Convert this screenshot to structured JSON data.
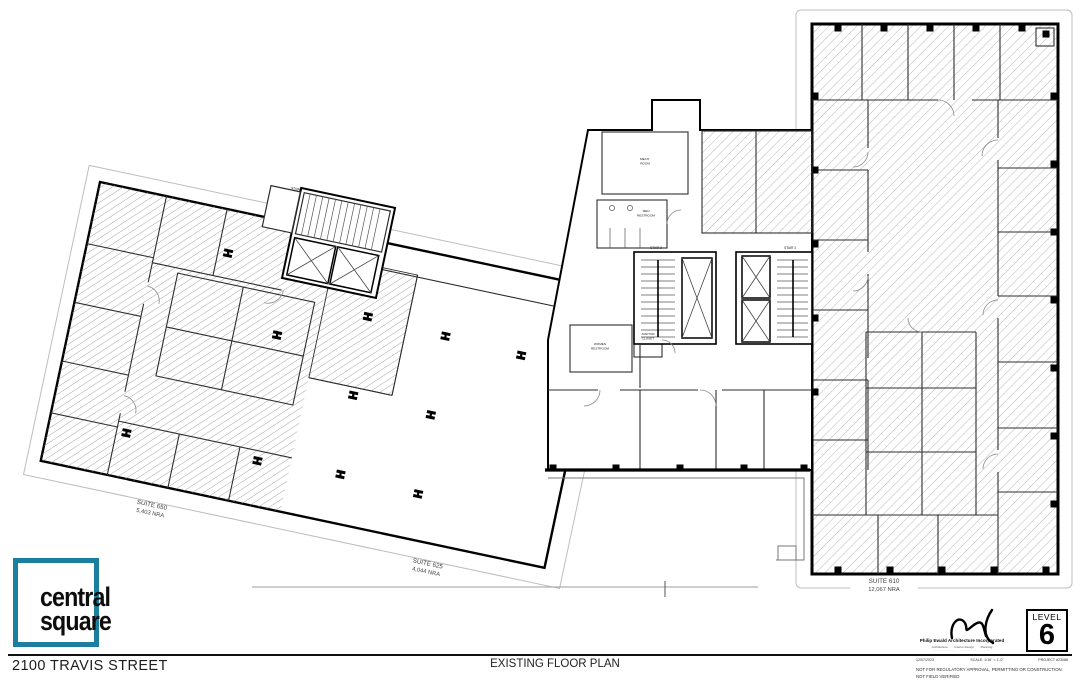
{
  "page": {
    "street_address": "2100 TRAVIS STREET",
    "drawing_title": "EXISTING FLOOR PLAN"
  },
  "logo": {
    "word1": "central",
    "word2": "square",
    "accent_color": "#1d7fa0"
  },
  "level_badge": {
    "label": "LEVEL",
    "number": "6"
  },
  "architect": {
    "name": "Philip Ewald Architecture Incorporated",
    "services_line": "Architecture        Interior Design        Planning",
    "address_line": "··· ········· ······ ····· ···   ······· ····· ·····   ··· ··· ····"
  },
  "title_row": {
    "date": "12/07/2023",
    "scale": "SCALE: 1/16\" = 1'-0\"",
    "project": "PROJECT #23086"
  },
  "notes": [
    "NOT FOR REGULATORY APPROVAL, PERMITTING OR CONSTRUCTION",
    "NOT FIELD VERIFIED"
  ],
  "suites": {
    "s650": {
      "name": "SUITE 650",
      "area": "5,403 NRA"
    },
    "s625": {
      "name": "SUITE 625",
      "area": "4,044 NRA"
    },
    "s610": {
      "name": "SUITE 610",
      "area": "12,067 NRA"
    }
  },
  "rooms": {
    "mech_l1": "MECH.",
    "mech_l2": "ROOM",
    "men_l1": "MEN",
    "men_l2": "RESTROOM",
    "women_l1": "WOMEN",
    "women_l2": "RESTROOM",
    "janitor_l1": "JANITOR",
    "janitor_l2": "CLOSET",
    "stair1": "STAIR 1",
    "stair2": "STAIR 2",
    "stair3": "STAIR 3"
  }
}
